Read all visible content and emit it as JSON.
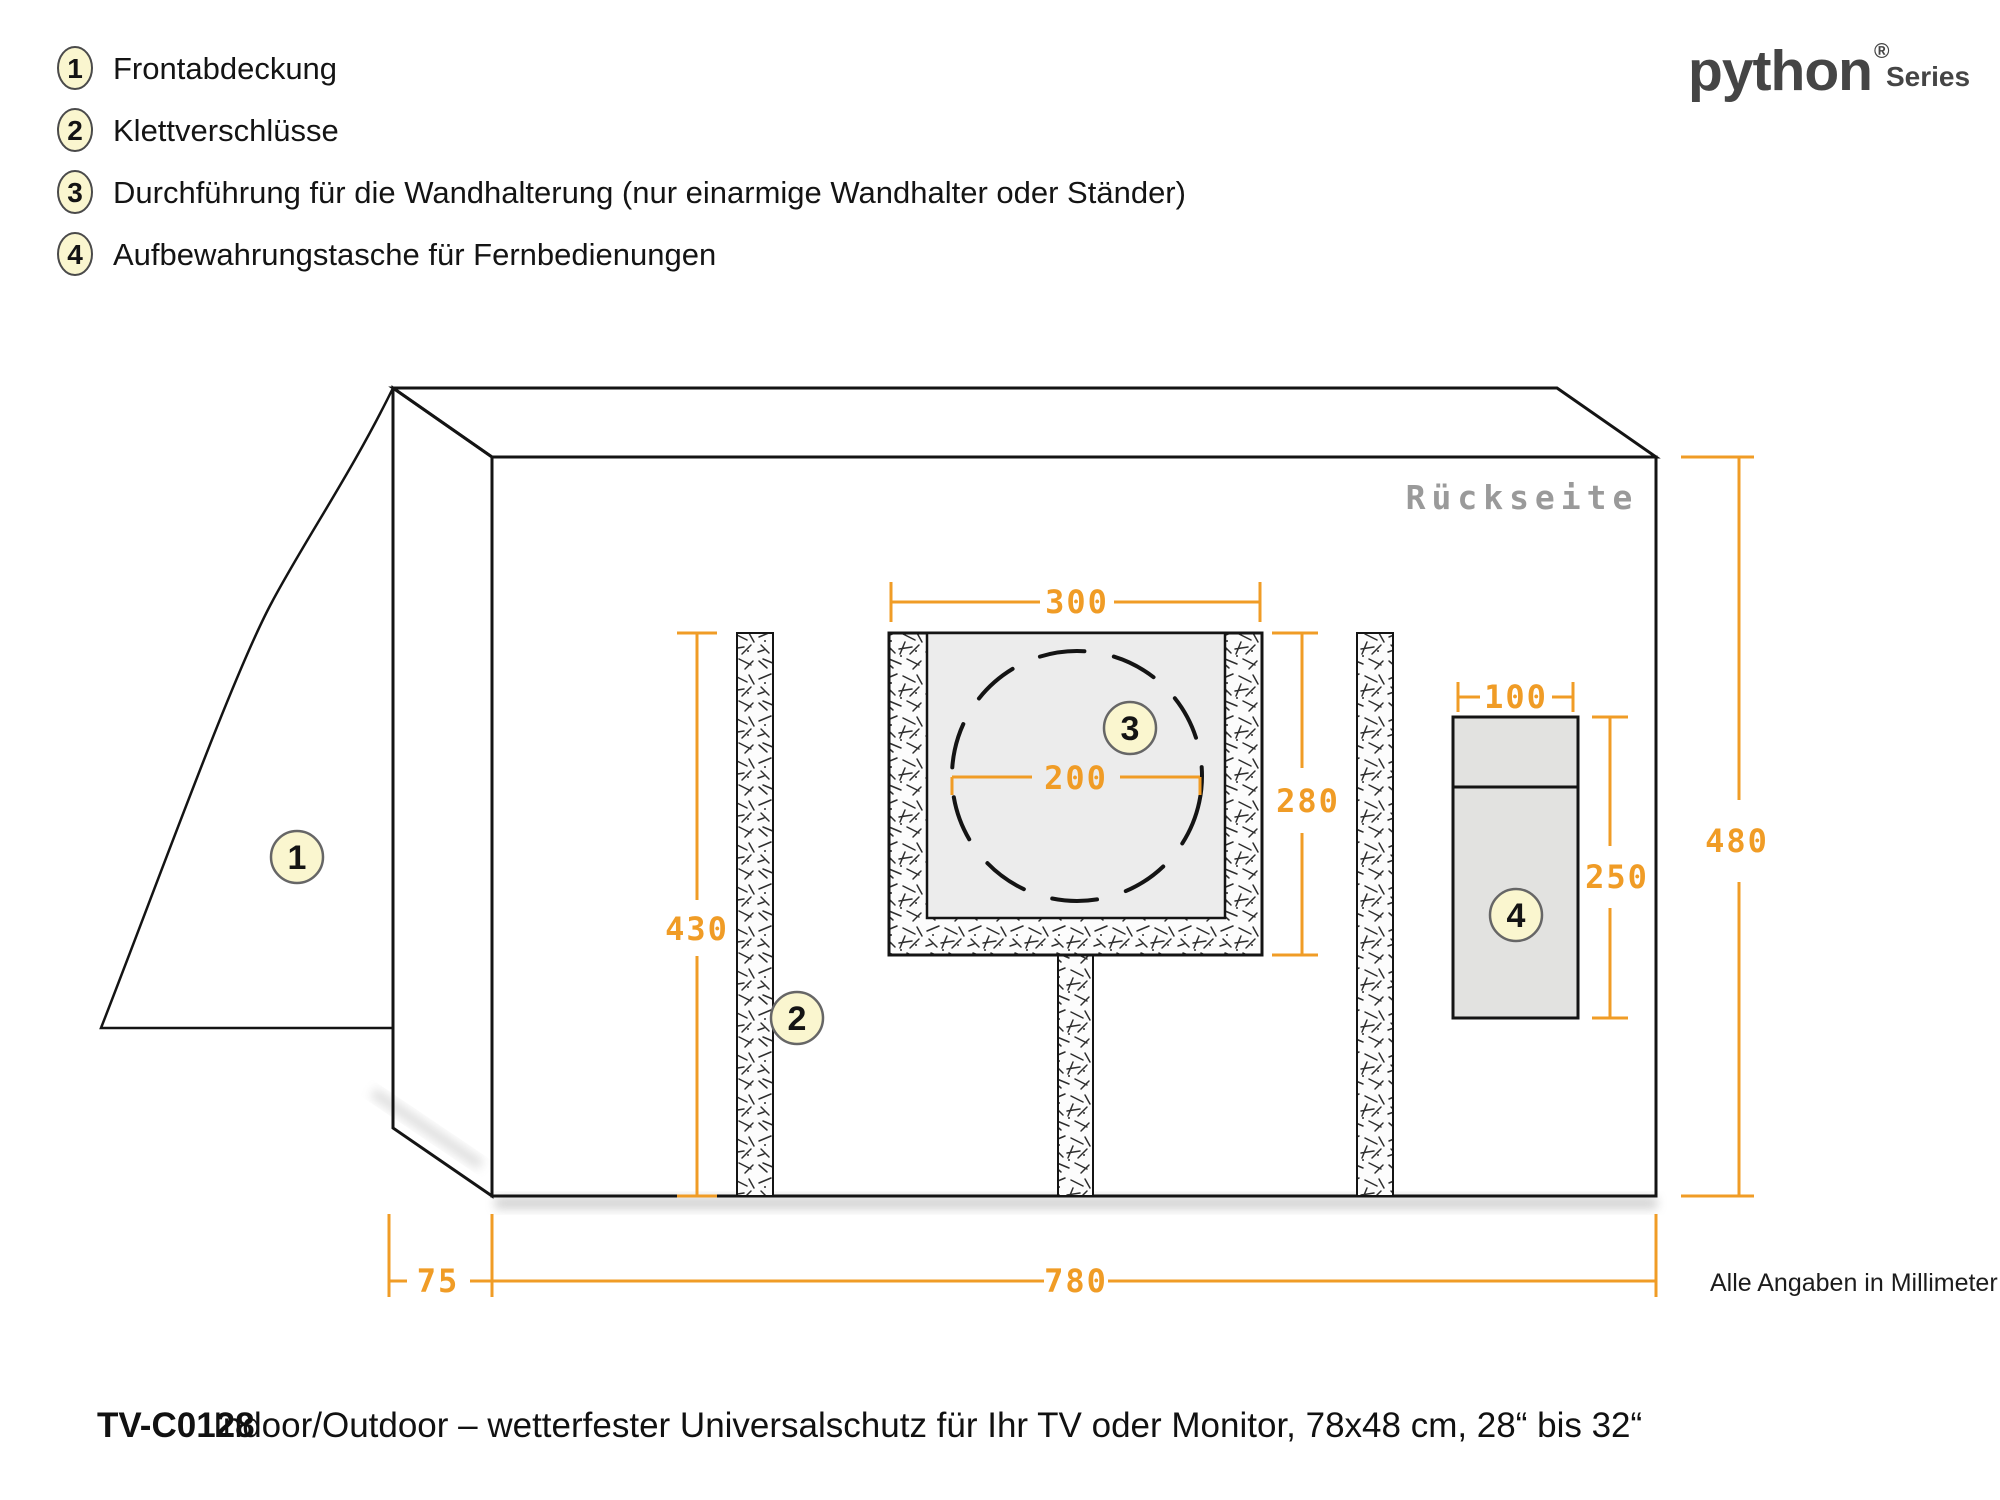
{
  "legend": {
    "items": [
      {
        "number": "1",
        "label": "Frontabdeckung"
      },
      {
        "number": "2",
        "label": "Klettverschlüsse"
      },
      {
        "number": "3",
        "label": "Durchführung für die Wandhalterung (nur einarmige Wandhalter oder Ständer)"
      },
      {
        "number": "4",
        "label": "Aufbewahrungstasche für Fernbedienungen"
      }
    ]
  },
  "logo": {
    "brand": "python",
    "registered": "®",
    "series": "Series"
  },
  "diagram": {
    "side_label": "Rückseite",
    "units_note": "Alle Angaben in Millimeter",
    "callouts": {
      "front_cover": "1",
      "velcro": "2",
      "wall_mount_opening": "3",
      "remote_pocket": "4"
    },
    "dimensions": {
      "opening_width": "300",
      "opening_height": "280",
      "opening_circle_diameter": "200",
      "velcro_length": "430",
      "pocket_width": "100",
      "pocket_height": "250",
      "cover_height": "480",
      "side_depth": "75",
      "cover_width": "780"
    }
  },
  "footer": {
    "model": "TV-C0128",
    "description": "Indoor/Outdoor – wetterfester Universalschutz für Ihr TV oder Monitor, 78x48 cm, 28“ bis 32“"
  },
  "colors": {
    "accent_orange": "#F09C26",
    "callout_fill": "#FAF6CF",
    "line_black": "#141414",
    "panel_gray": "#ECECEC"
  }
}
